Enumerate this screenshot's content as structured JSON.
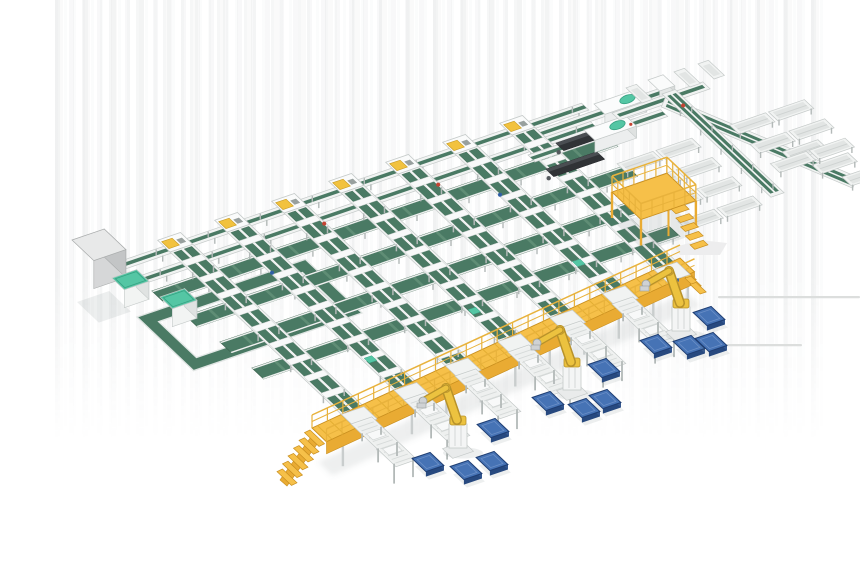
{
  "canvas": {
    "width": 860,
    "height": 580,
    "background": "#ffffff"
  },
  "axes": {
    "e": [
      0.946,
      -0.324
    ],
    "s": [
      0.726,
      0.688
    ],
    "branch": [
      0.92,
      0.39
    ]
  },
  "colors": {
    "frame": "#f1f3f2",
    "frame_stroke": "#c5cac9",
    "frame_inner": "#e2e5e4",
    "head_fill": "#fafbfb",
    "belt": "#4a7a64",
    "belt_dark": "#3c644f",
    "belt_light": "#5f8d75",
    "belt_rim": "#eef0ef",
    "mint": "#54c6a4",
    "mint_dark": "#36a182",
    "yellow": "#f6c049",
    "yellow_shade": "#e9ab33",
    "yellow_edge": "#c98f1f",
    "yellow_rail": "#e8b23c",
    "robot_yellow": "#ecc23f",
    "robot_outline": "#b8922a",
    "robot_gray": "#cfd2d4",
    "robot_gray_dark": "#9aa0a0",
    "pallet_top": "#4673b5",
    "pallet_side": "#27497f",
    "pallet_side2": "#33568f",
    "pallet_edge": "#1e3d72",
    "pallet_rim": "#6b8fc7",
    "dark_body": "#303336",
    "dark_top": "#4a4e52",
    "gray_top": "#e8e9e9",
    "gray_front": "#d6d7d8",
    "gray_side": "#c3c5c6",
    "gray_stroke": "#a9acac",
    "leg": "#b3b9b8",
    "carriage": "#f8f9f9",
    "carriage_stroke": "#d0d4d3",
    "dot_red": "#c44433",
    "dot_blue": "#2f5fa5",
    "dot_yellow": "#f2c23e",
    "shadow": "rgba(110,120,125,0.12)",
    "floor_line": "#dcdedd",
    "ghost": "#ededee"
  },
  "sorter_lines": [
    {
      "x": 170,
      "y": 252,
      "len": 236
    },
    {
      "x": 227,
      "y": 232,
      "len": 230
    },
    {
      "x": 284,
      "y": 213,
      "len": 222
    },
    {
      "x": 341,
      "y": 193,
      "len": 216
    },
    {
      "x": 398,
      "y": 174,
      "len": 209
    },
    {
      "x": 455,
      "y": 154,
      "len": 203
    },
    {
      "x": 512,
      "y": 135,
      "len": 196
    }
  ],
  "cross_lines": [
    {
      "x": 118,
      "y": 262,
      "len": 490,
      "kind": "narrow"
    },
    {
      "x": 122,
      "y": 282,
      "len": 495,
      "kind": "narrow"
    },
    {
      "x": 152,
      "y": 291,
      "len": 480,
      "kind": "belt"
    },
    {
      "x": 186,
      "y": 316,
      "len": 465,
      "kind": "belt"
    },
    {
      "x": 220,
      "y": 342,
      "len": 452,
      "kind": "belt"
    },
    {
      "x": 252,
      "y": 368,
      "len": 440,
      "kind": "belt"
    }
  ],
  "infeed_lines": [
    {
      "x": 538,
      "y": 130,
      "len": 130
    },
    {
      "x": 528,
      "y": 155,
      "len": 140
    }
  ],
  "unloaders": [
    {
      "x": 594,
      "y": 116
    },
    {
      "x": 584,
      "y": 142
    }
  ],
  "top_right": {
    "ext_line": {
      "x": 612,
      "y": 113,
      "len": 96
    },
    "junction": {
      "x": 648,
      "y": 86
    },
    "sort_line": {
      "x": 662,
      "y": 94,
      "len": 150
    },
    "branch_line": {
      "x": 666,
      "y": 96,
      "len": 208
    },
    "left_chute_ts": [
      58,
      86,
      114,
      142
    ],
    "right_chute_ts": [
      58,
      86,
      114
    ],
    "corner_chutes": [
      [
        642,
        103
      ],
      [
        666,
        95
      ],
      [
        690,
        87
      ],
      [
        714,
        79
      ]
    ],
    "edge_chutes": [
      [
        782,
        152
      ],
      [
        812,
        165
      ],
      [
        842,
        177
      ]
    ],
    "floor_lines": [
      [
        718,
        296,
        142
      ],
      [
        718,
        344,
        84
      ]
    ],
    "ghost": [
      [
        675,
        247
      ],
      [
        700,
        240
      ],
      [
        727,
        243
      ],
      [
        720,
        255
      ],
      [
        680,
        255
      ]
    ]
  },
  "loop": {
    "x": 137,
    "y": 317,
    "elen": 178,
    "slen": 78,
    "band": 13
  },
  "cabinets": [
    {
      "x": 112,
      "y": 296
    },
    {
      "x": 160,
      "y": 315
    }
  ],
  "gray_box": {
    "x": 72,
    "y": 268,
    "elen": 34,
    "slen": 30,
    "h": 28
  },
  "mezzanine": {
    "x": 612,
    "y": 218,
    "elen": 58,
    "slen": 40,
    "h": 26,
    "rail": 16
  },
  "walkway": {
    "x1": 312,
    "y1": 428,
    "x2": 680,
    "y2": 258,
    "w": 20,
    "skirt": 12,
    "leg": 20,
    "rail": 13
  },
  "spurs": [
    {
      "x": 351,
      "y": 424
    },
    {
      "x": 404,
      "y": 400
    },
    {
      "x": 455,
      "y": 376
    },
    {
      "x": 508,
      "y": 352
    },
    {
      "x": 560,
      "y": 328
    },
    {
      "x": 612,
      "y": 304
    }
  ],
  "spur_len": 62,
  "robots": [
    {
      "x": 458,
      "y": 450
    },
    {
      "x": 572,
      "y": 392
    },
    {
      "x": 681,
      "y": 333
    }
  ],
  "pallets": [
    [
      428,
      467
    ],
    [
      466,
      475
    ],
    [
      492,
      466
    ],
    [
      493,
      433
    ],
    [
      548,
      406
    ],
    [
      584,
      413
    ],
    [
      605,
      404
    ],
    [
      604,
      373
    ],
    [
      656,
      349
    ],
    [
      689,
      350
    ],
    [
      711,
      347
    ],
    [
      709,
      321
    ]
  ]
}
